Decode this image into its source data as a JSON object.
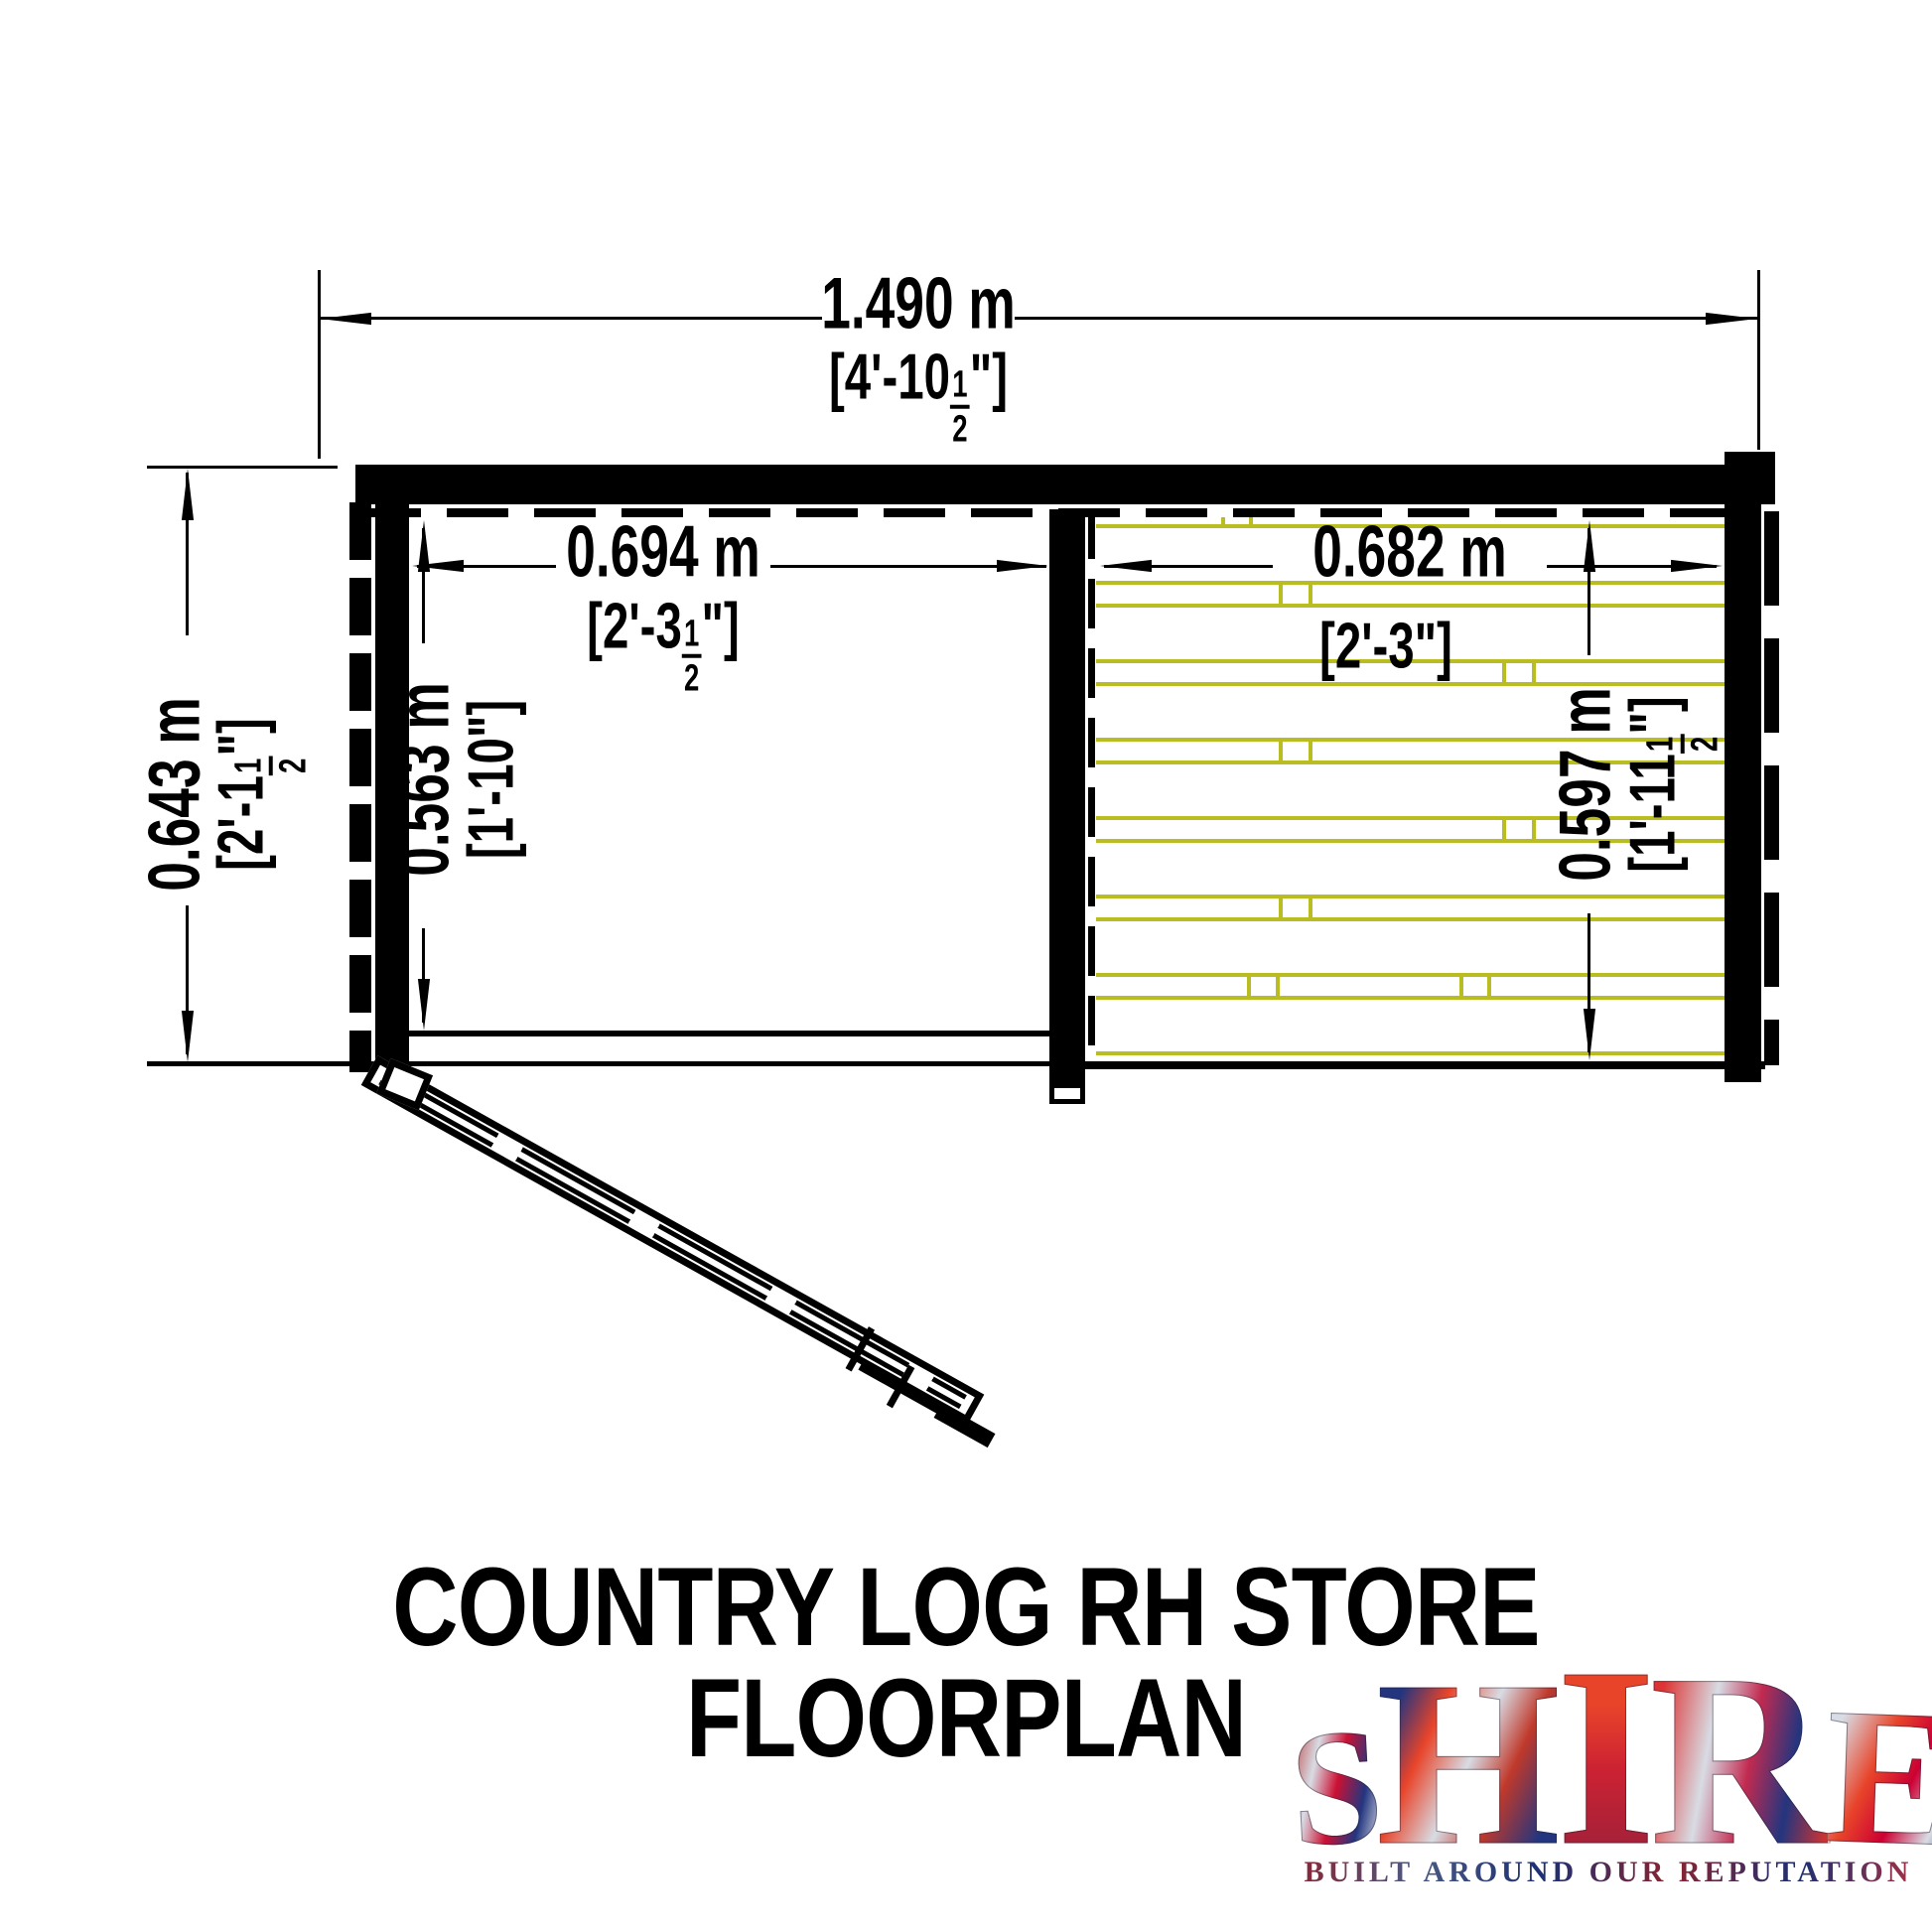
{
  "title": "COUNTRY LOG RH STORE FLOORPLAN",
  "dimensions": {
    "overall_width": {
      "metric": "1.490 m",
      "imperial_pre": "[4'-10",
      "imperial_num": "1",
      "imperial_den": "2",
      "imperial_post": "\"]"
    },
    "overall_depth": {
      "metric": "0.643 m",
      "imperial_pre": "[2'-1",
      "imperial_num": "1",
      "imperial_den": "2",
      "imperial_post": "\"]"
    },
    "left_room_width": {
      "metric": "0.694 m",
      "imperial_pre": "[2'-3",
      "imperial_num": "1",
      "imperial_den": "2",
      "imperial_post": "\"]"
    },
    "left_room_depth": {
      "metric": "0.563 m",
      "imperial": "[1'-10\"]"
    },
    "right_room_width": {
      "metric": "0.682 m",
      "imperial": "[2'-3\"]"
    },
    "right_room_depth": {
      "metric": "0.597 m",
      "imperial_pre": "[1'-11",
      "imperial_num": "1",
      "imperial_den": "2",
      "imperial_post": "\"]"
    }
  },
  "logo": {
    "brand": "SHIRE",
    "letters": [
      "S",
      "H",
      "I",
      "R",
      "E"
    ],
    "tagline": "BUILT AROUND OUR REPUTATION"
  },
  "colors": {
    "line": "#000000",
    "plank_yellow": "#b9bd22",
    "logo_navy": "#23357f",
    "logo_red": "#cc2233",
    "logo_silver": "#d8dce4"
  }
}
